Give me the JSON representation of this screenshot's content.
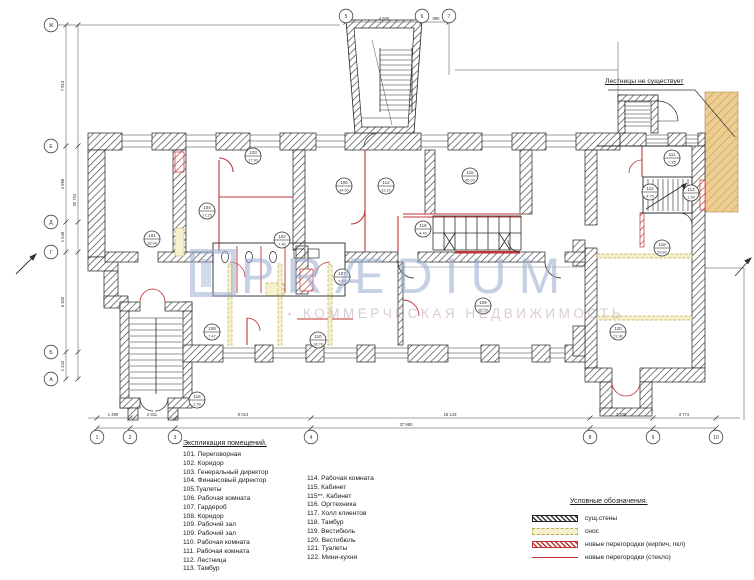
{
  "colors": {
    "wall": "#2a2a2a",
    "accent_red": "#c03434",
    "demolition_fill": "#f6f1cc",
    "tan_fill": "#eccd92",
    "watermark_blue": "#96aacd",
    "watermark_pink": "#bea0b4"
  },
  "note": {
    "text": "Лестницы не существует"
  },
  "watermark": {
    "bullet": "▪",
    "brand": "PRÆDIUM",
    "subtitle": "КОММЕРЧЕСКАЯ НЕДВИЖИМОСТЬ"
  },
  "explication": {
    "title": "Экспликация помещений.",
    "col1": [
      "101. Переговорная",
      "102. Коридор",
      "103. Генеральный директор",
      "104. Финансовый директор",
      "105.Туалеты",
      "106. Рабочая комната",
      "107. Гардероб",
      "108. Коридор",
      "109. Рабочий зал",
      "109. Рабочий зал",
      "110. Рабочая комната",
      "111. Рабочая комната",
      "112. Лестница",
      "113. Тамбур"
    ],
    "col2": [
      "114. Рабочая комната",
      "115. Кабинет",
      "115**. Кабинет",
      "116. Оргтехника",
      "117. Холл клиентов",
      "118. Тамбур",
      "119. Вестибюль",
      "120. Вестибюль",
      "121. Туалеты",
      "122. Мини-кухня"
    ]
  },
  "legend": {
    "title": "Условные обозначения.",
    "items": [
      {
        "key": "existing",
        "label": "сущ.стены"
      },
      {
        "key": "demolition",
        "label": "снос"
      },
      {
        "key": "new_brick",
        "label": "новые перегородки (кирпич, пкл)"
      },
      {
        "key": "new_glass",
        "label": "новые перегородки (стекло)"
      }
    ]
  },
  "axes": {
    "bottom": [
      {
        "label": "1",
        "x": 97
      },
      {
        "label": "2",
        "x": 130
      },
      {
        "label": "3",
        "x": 175
      },
      {
        "label": "4",
        "x": 311
      },
      {
        "label": "8",
        "x": 590
      },
      {
        "label": "9",
        "x": 653
      },
      {
        "label": "10",
        "x": 716
      }
    ],
    "bottom_y": 437,
    "top": [
      {
        "label": "5",
        "x": 346
      },
      {
        "label": "6",
        "x": 422
      },
      {
        "label": "7",
        "x": 449
      }
    ],
    "top_y": 16,
    "left": [
      {
        "label": "Ж",
        "y": 25
      },
      {
        "label": "Е",
        "y": 146
      },
      {
        "label": "Д",
        "y": 222
      },
      {
        "label": "Г",
        "y": 252
      },
      {
        "label": "Б",
        "y": 352
      },
      {
        "label": "А",
        "y": 379
      }
    ],
    "left_x": 51
  },
  "dimensions": {
    "bottom_segments": [
      {
        "text": "1 490",
        "x": 113
      },
      {
        "text": "2 911",
        "x": 152
      },
      {
        "text": "9 014",
        "x": 243
      },
      {
        "text": "18 143",
        "x": 450
      },
      {
        "text": "3 709",
        "x": 621
      },
      {
        "text": "3 774",
        "x": 684
      }
    ],
    "bottom_y": 416,
    "bottom_total": {
      "text": "37 980",
      "x": 406,
      "y": 426
    },
    "top_segments": [
      {
        "text": "4 500",
        "x": 384
      },
      {
        "text": "890",
        "x": 436
      }
    ],
    "top_y": 20,
    "left_segments": [
      {
        "text": "7 913",
        "y": 86
      },
      {
        "text": "4 898",
        "y": 184
      },
      {
        "text": "1 648",
        "y": 237
      },
      {
        "text": "6 300",
        "y": 302
      },
      {
        "text": "1 443",
        "y": 366
      }
    ],
    "left_x": 64,
    "left_total": {
      "text": "20 704",
      "x": 76,
      "y": 200
    }
  },
  "rooms": [
    {
      "num": "101",
      "area": "28.94",
      "x": 152,
      "y": 239
    },
    {
      "num": "103",
      "area": "17.90",
      "x": 253,
      "y": 156
    },
    {
      "num": "104",
      "area": "17.25",
      "x": 207,
      "y": 211
    },
    {
      "num": "102",
      "area": "7.40",
      "x": 282,
      "y": 240
    },
    {
      "num": "106",
      "area": "34.50",
      "x": 344,
      "y": 186
    },
    {
      "num": "114",
      "area": "33.10",
      "x": 386,
      "y": 186
    },
    {
      "num": "115",
      "area": "45.20",
      "x": 470,
      "y": 176
    },
    {
      "num": "116",
      "area": "4.40",
      "x": 423,
      "y": 229
    },
    {
      "num": "107",
      "area": "7.10",
      "x": 342,
      "y": 277
    },
    {
      "num": "108",
      "area": "7.47",
      "x": 212,
      "y": 332
    },
    {
      "num": "110",
      "area": "18.78",
      "x": 318,
      "y": 340
    },
    {
      "num": "109",
      "area": "92.29",
      "x": 483,
      "y": 306
    },
    {
      "num": "118",
      "area": "1.99",
      "x": 197,
      "y": 400
    },
    {
      "num": "111",
      "area": "7.85",
      "x": 672,
      "y": 158
    },
    {
      "num": "112",
      "area": "4.75",
      "x": 650,
      "y": 192
    },
    {
      "num": "113",
      "area": "1.50",
      "x": 691,
      "y": 193
    },
    {
      "num": "119",
      "area": "53.82",
      "x": 662,
      "y": 248
    },
    {
      "num": "120",
      "area": "21.90",
      "x": 618,
      "y": 332
    }
  ]
}
